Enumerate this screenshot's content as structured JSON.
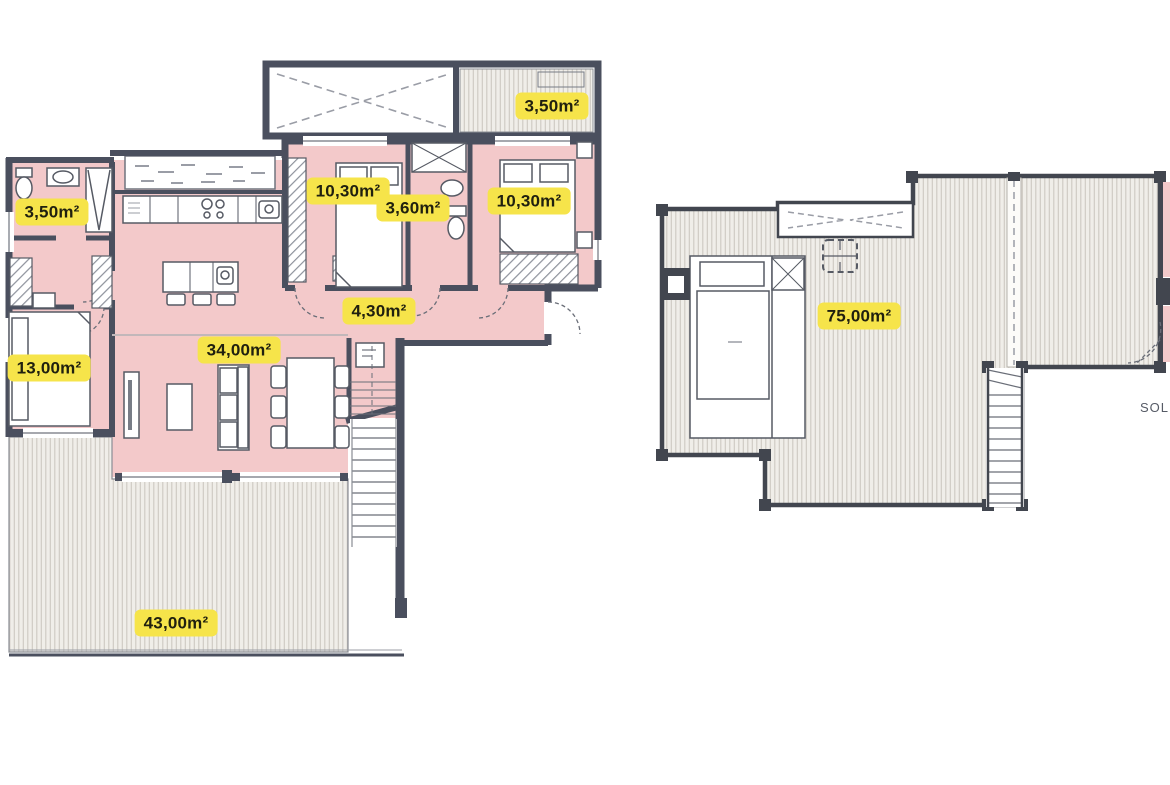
{
  "page": {
    "kind": "architectural floor plan drawing",
    "background": "#ffffff"
  },
  "colors": {
    "wall": "#4a4f5e",
    "room_fill": "#f3c9ca",
    "deck_fill": "#f0eee9",
    "deck_stripe": "#ccc8c1",
    "label_bg": "#f6e44a",
    "label_text": "#20200f"
  },
  "plans": [
    {
      "name": "main-floor",
      "area_labels": [
        {
          "id": "upper-terrace",
          "text": "3,50m²"
        },
        {
          "id": "bedroom-1",
          "text": "10,30m²"
        },
        {
          "id": "bathroom",
          "text": "3,60m²"
        },
        {
          "id": "bedroom-2",
          "text": "10,30m²"
        },
        {
          "id": "bathroom-left",
          "text": "3,50m²"
        },
        {
          "id": "hallway",
          "text": "4,30m²"
        },
        {
          "id": "living-kitchen",
          "text": "34,00m²"
        },
        {
          "id": "bedroom-3",
          "text": "13,00m²"
        },
        {
          "id": "terrace",
          "text": "43,00m²"
        }
      ]
    },
    {
      "name": "solarium-floor",
      "area_labels": [
        {
          "id": "solarium",
          "text": "75,00m²"
        }
      ],
      "edge_label": {
        "text": "SOL"
      }
    }
  ]
}
